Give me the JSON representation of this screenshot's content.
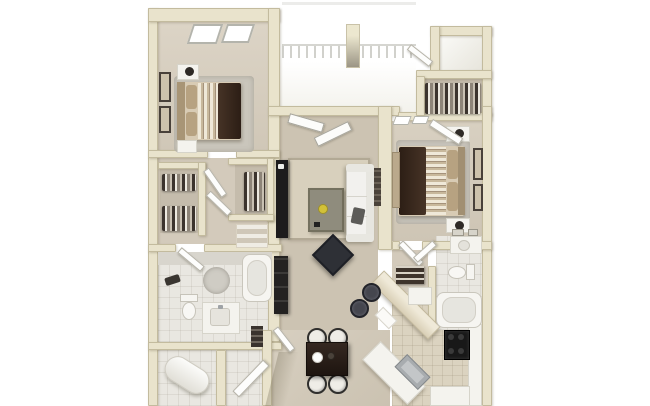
{
  "scene": {
    "description": "3D top-down rendering of a two-bedroom, two-bathroom apartment floor plan with balcony",
    "view": "birds-eye dollhouse render",
    "background": "#ffffff"
  },
  "palette": {
    "wall": "#e9e3cc",
    "wall_edge": "#c3bb9e",
    "carpet": "#d3cabb",
    "living_carpet": "#ccc3b2",
    "area_rug": "#d8d0bd",
    "bath_tile": "#e9e7e1",
    "kitchen_tile": "#dbd3c0",
    "balcony_white": "#fcfcfb",
    "espresso_wood": "#3a2a20",
    "sofa_white": "#f2f1ee",
    "accent_black": "#2e3036",
    "counter_white": "#f4f3ee",
    "stainless": "#a8acaf",
    "stove_black": "#181818",
    "lamp_bowl_yellow": "#d2c138"
  },
  "rooms": {
    "bedroom1": {
      "label": "Bedroom 1",
      "furniture": [
        "queen-bed",
        "striped-duvet",
        "espresso-throw",
        "two-nightstands",
        "table-lamp",
        "wall-art",
        "area-rug",
        "windows"
      ]
    },
    "balcony": {
      "label": "Balcony / Patio",
      "furniture": [
        "railing",
        "support-column",
        "french-doors"
      ]
    },
    "closet_top_right": {
      "label": "Walk-in Closet (Bedroom 2)",
      "furniture": [
        "hanging-clothes",
        "shelf-compartment"
      ]
    },
    "living_room": {
      "label": "Living Room",
      "furniture": [
        "white-sofa",
        "coffee-table",
        "media-console",
        "accent-ottoman",
        "area-rug",
        "bookcase"
      ]
    },
    "bedroom2": {
      "label": "Bedroom 2",
      "furniture": [
        "queen-bed",
        "striped-duvet",
        "espresso-throw",
        "two-nightstands",
        "wall-art",
        "dresser",
        "windows"
      ]
    },
    "hall_closets": {
      "label": "Hall & Walk-in Closets",
      "furniture": [
        "hanging-clothes",
        "linen-shelves"
      ]
    },
    "bathroom1": {
      "label": "Bathroom 1",
      "furniture": [
        "toilet",
        "vanity-sink",
        "bathtub",
        "round-rug",
        "towel"
      ]
    },
    "bathroom2": {
      "label": "Bathroom 2",
      "furniture": [
        "toilet",
        "vanity-sink",
        "bathtub",
        "mirror-cabinet"
      ]
    },
    "kitchen": {
      "label": "Kitchen",
      "furniture": [
        "breakfast-bar",
        "two-bar-stools",
        "range",
        "stainless-sink",
        "counters",
        "pantry-shelves"
      ]
    },
    "dining": {
      "label": "Dining Area",
      "furniture": [
        "espresso-table",
        "four-white-chairs",
        "centerpiece"
      ]
    },
    "entry": {
      "label": "Entry / Foyer",
      "furniture": [
        "front-door",
        "coat-shelf"
      ]
    },
    "utility": {
      "label": "Utility Closet",
      "furniture": [
        "water-heater"
      ]
    }
  }
}
